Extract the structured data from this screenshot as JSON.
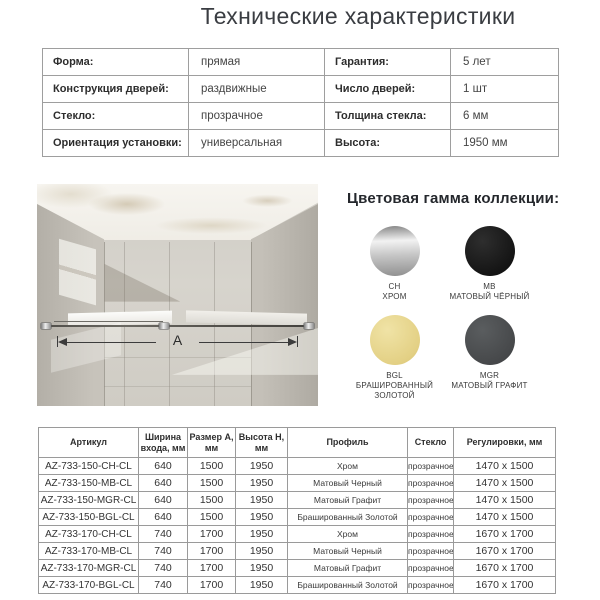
{
  "title": "Технические характеристики",
  "spec_table": {
    "rows": [
      {
        "l1": "Форма:",
        "v1": "прямая",
        "l2": "Гарантия:",
        "v2": "5 лет"
      },
      {
        "l1": "Конструкция дверей:",
        "v1": "раздвижные",
        "l2": "Число дверей:",
        "v2": "1 шт"
      },
      {
        "l1": "Стекло:",
        "v1": "прозрачное",
        "l2": "Толщина стекла:",
        "v2": "6 мм"
      },
      {
        "l1": "Ориентация установки:",
        "v1": "универсальная",
        "l2": "Высота:",
        "v2": "1950 мм"
      }
    ]
  },
  "product_image": {
    "dimension_label": "A"
  },
  "palette": {
    "heading": "Цветовая гамма коллекции:",
    "swatches": [
      {
        "code": "CH",
        "name": "ХРОМ",
        "finish": "chrome",
        "colors": {
          "light": "#f2f2f2",
          "mid": "#c6c6c6",
          "dark": "#8f8f8f"
        }
      },
      {
        "code": "MB",
        "name": "МАТОВЫЙ ЧЁРНЫЙ",
        "finish": "flat",
        "colors": {
          "light": "#2e2e2e",
          "mid": "#141414",
          "dark": "#0d0d0d"
        }
      },
      {
        "code": "BGL",
        "name": "БРАШИРОВАННЫЙ ЗОЛОТОЙ",
        "finish": "flat",
        "colors": {
          "light": "#f0e3a6",
          "mid": "#e3d084",
          "dark": "#d6c273"
        }
      },
      {
        "code": "MGR",
        "name": "МАТОВЫЙ ГРАФИТ",
        "finish": "flat",
        "colors": {
          "light": "#5a5d5f",
          "mid": "#46484a",
          "dark": "#3d3f41"
        }
      }
    ]
  },
  "lower_table": {
    "headers": [
      "Артикул",
      "Ширина входа, мм",
      "Размер A, мм",
      "Высота H, мм",
      "Профиль",
      "Стекло",
      "Регулировки, мм"
    ],
    "rows": [
      [
        "AZ-733-150-CH-CL",
        "640",
        "1500",
        "1950",
        "Хром",
        "прозрачное",
        "1470 x 1500"
      ],
      [
        "AZ-733-150-MB-CL",
        "640",
        "1500",
        "1950",
        "Матовый Черный",
        "прозрачное",
        "1470 x 1500"
      ],
      [
        "AZ-733-150-MGR-CL",
        "640",
        "1500",
        "1950",
        "Матовый Графит",
        "прозрачное",
        "1470 x 1500"
      ],
      [
        "AZ-733-150-BGL-CL",
        "640",
        "1500",
        "1950",
        "Брашированный Золотой",
        "прозрачное",
        "1470 x 1500"
      ],
      [
        "AZ-733-170-CH-CL",
        "740",
        "1700",
        "1950",
        "Хром",
        "прозрачное",
        "1670 x 1700"
      ],
      [
        "AZ-733-170-MB-CL",
        "740",
        "1700",
        "1950",
        "Матовый Черный",
        "прозрачное",
        "1670 x 1700"
      ],
      [
        "AZ-733-170-MGR-CL",
        "740",
        "1700",
        "1950",
        "Матовый Графит",
        "прозрачное",
        "1670 x 1700"
      ],
      [
        "AZ-733-170-BGL-CL",
        "740",
        "1700",
        "1950",
        "Брашированный Золотой",
        "прозрачное",
        "1670 x 1700"
      ]
    ]
  }
}
